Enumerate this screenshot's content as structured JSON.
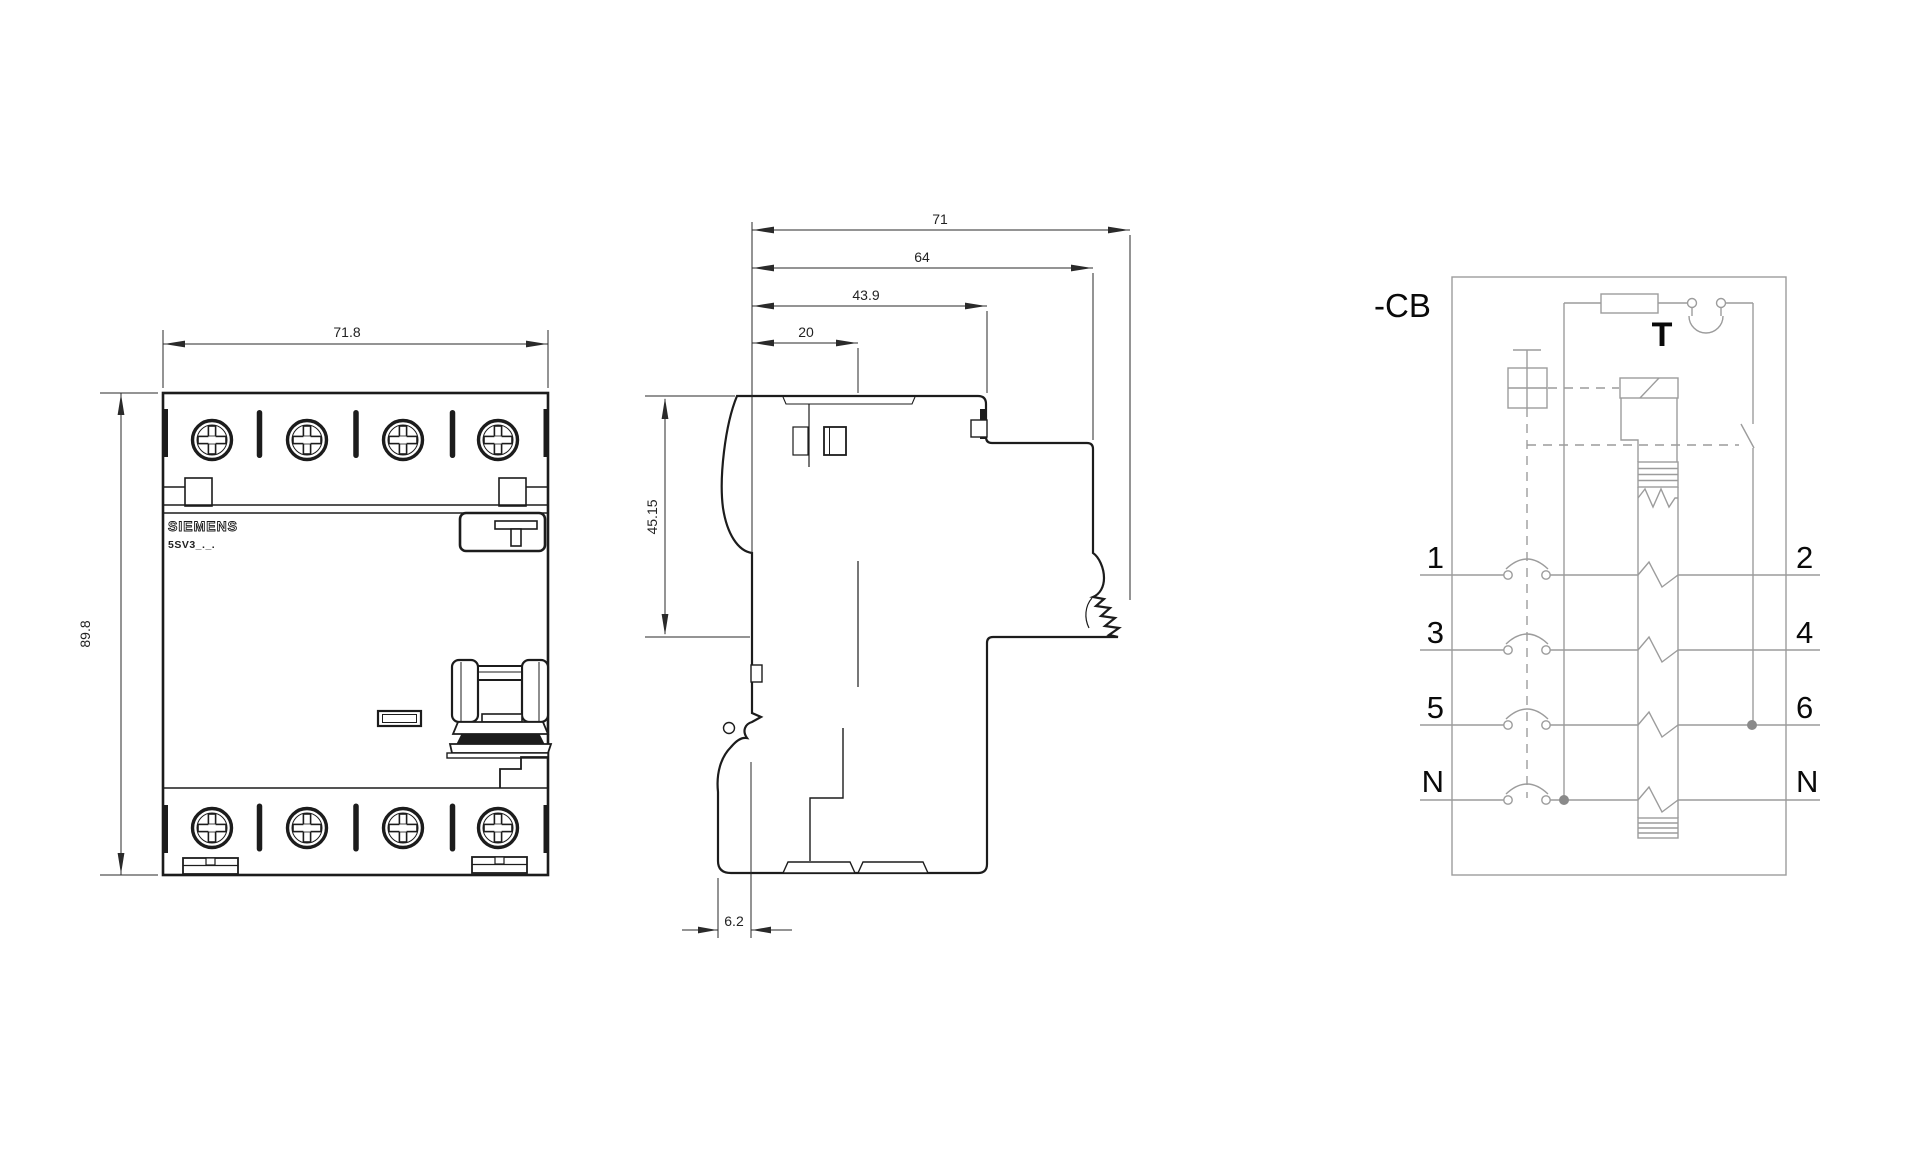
{
  "front_view": {
    "width": "71.8",
    "height": "89.8",
    "brand": "SIEMENS",
    "model": "5SV3_._."
  },
  "side_view": {
    "total_depth": "71",
    "housing_depth": "64",
    "rail_depth": "43.9",
    "front_depth": "20",
    "front_height": "45.15",
    "bottom_offset": "6.2"
  },
  "circuit": {
    "device_label": "-CB",
    "test_button_label": "T",
    "left_terminals": [
      "1",
      "3",
      "5",
      "N"
    ],
    "right_terminals": [
      "2",
      "4",
      "6",
      "N"
    ]
  },
  "colors": {
    "drawing_line": "#1c1c1c",
    "dimension_line": "#2a2a2a",
    "schematic_line": "#9c9c9c",
    "background": "#ffffff"
  }
}
